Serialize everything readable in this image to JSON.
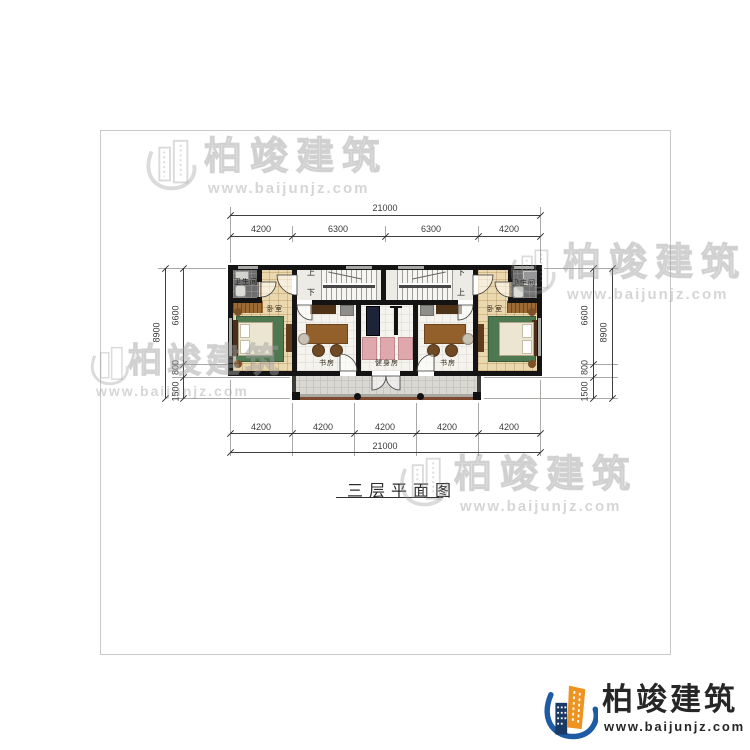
{
  "title": {
    "text": "三层平面图"
  },
  "brand": {
    "name": "柏竣建筑",
    "url": "www.baijunjz.com"
  },
  "dims": {
    "top_total": "21000",
    "top_segs": [
      "4200",
      "6300",
      "6300",
      "4200"
    ],
    "bottom_segs": [
      "4200",
      "4200",
      "4200",
      "4200",
      "4200"
    ],
    "bottom_total": "21000",
    "left_total": "8900",
    "left_segs": [
      "6600",
      "800",
      "1500"
    ],
    "right_total": "8900",
    "right_segs": [
      "6600",
      "800",
      "1500"
    ]
  },
  "rooms": {
    "bathroom_left": "卫生间",
    "bathroom_right": "卫生间",
    "bedroom_left": "卧室",
    "bedroom_right": "卧室",
    "study_left": "书房",
    "study_right": "书房",
    "gym": "健身房"
  },
  "stairs": {
    "up_left": "上",
    "down_left": "下",
    "down_right": "下",
    "up_right": "上"
  },
  "colors": {
    "accent_blue": "#1d5ba5",
    "accent_orange": "#ef9320",
    "wall": "#141414"
  }
}
